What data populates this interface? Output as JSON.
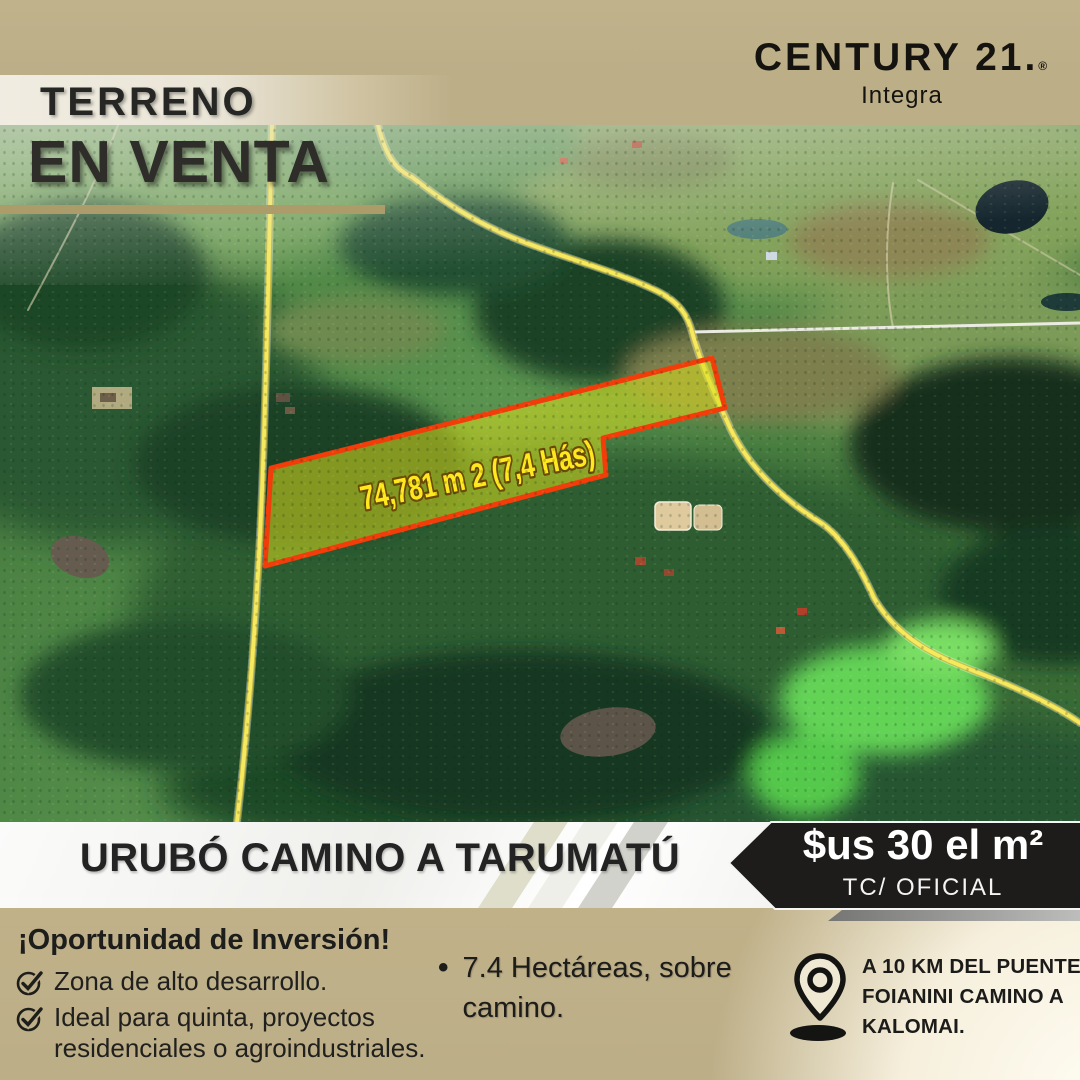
{
  "brand": {
    "name": "CENTURY 21.",
    "registered": "®",
    "agency": "Integra"
  },
  "header": {
    "kicker": "TERRENO",
    "title": "EN VENTA"
  },
  "map": {
    "parcel_label": "74,781 m 2  (7,4 Hás)"
  },
  "location_bar": {
    "title": "URUBÓ CAMINO A TARUMATÚ"
  },
  "price_badge": {
    "price": "$us 30 el m²",
    "exchange_note": "TC/ OFICIAL"
  },
  "details": {
    "opportunity_title": "¡Oportunidad de Inversión!",
    "checklist": [
      {
        "label": "Zona de alto desarrollo."
      },
      {
        "label": "Ideal para quinta, proyectos residenciales o agroindustriales."
      }
    ],
    "area_bullet": "7.4 Hectáreas, sobre camino.",
    "bullet_glyph": "•",
    "distance_note": "A 10 KM DEL PUENTE FOIANINI CAMINO A KALOMAI."
  },
  "colors": {
    "tan_band": "#bcae87",
    "cream_strip": "#f0ece1",
    "gold_bar": "#ab9c69",
    "badge_black": "#1d1c1a",
    "parcel_fill": "#d8de1e",
    "parcel_border": "#f23c0a",
    "parcel_label_yellow": "#ffe91e",
    "road_yellow": "#f6e95e",
    "text_dark": "#262624",
    "white_band": "#ffffff"
  }
}
